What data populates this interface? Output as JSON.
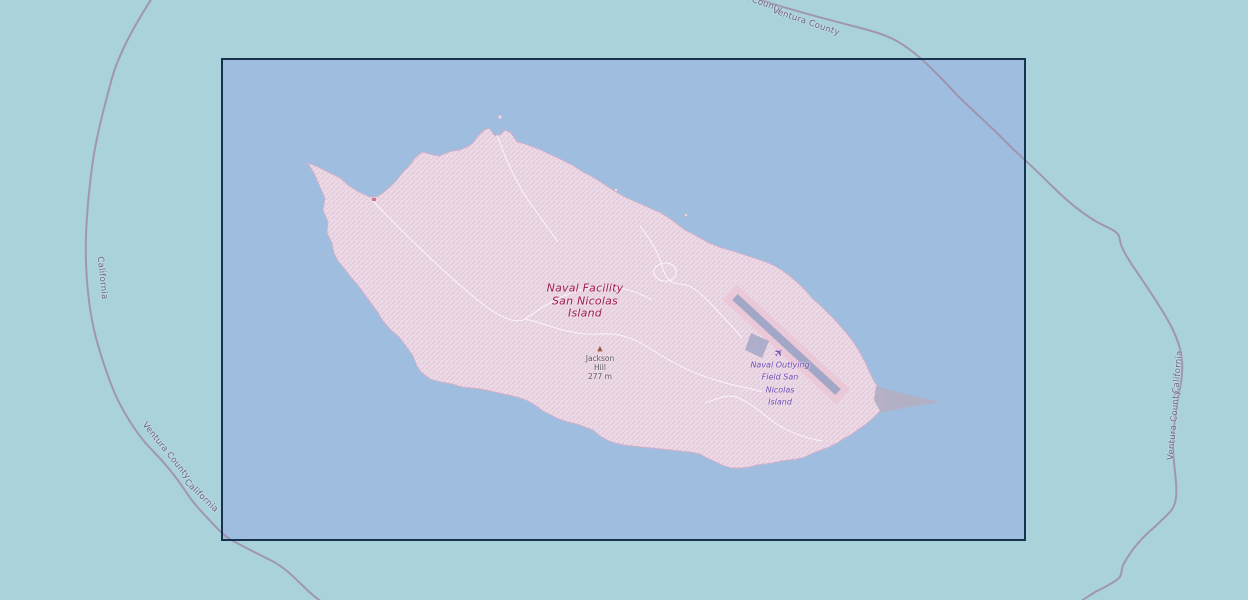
{
  "map": {
    "labels": {
      "naval_facility": {
        "lines": [
          "Naval Facility",
          "San Nicolas",
          "Island"
        ]
      },
      "peak": {
        "lines": [
          "Jackson",
          "Hill",
          "277 m"
        ]
      },
      "airfield": {
        "lines": [
          "Naval Outlying",
          "Field San",
          "Nicolas",
          "Island"
        ]
      },
      "boundaries": [
        {
          "text": "Santa Barbara County"
        },
        {
          "text": "Ventura County"
        },
        {
          "text": "California"
        },
        {
          "text": "Ventura County"
        },
        {
          "text": "California"
        },
        {
          "text": "California"
        },
        {
          "text": "Ventura County"
        }
      ]
    },
    "icons": {
      "airfield_glyph": "✈",
      "peak_glyph": "▲"
    },
    "colors": {
      "ocean_outside": "#aad2da",
      "ocean_inside": "#9fbedf",
      "viewport_border": "#16324f",
      "military_area_fill": "#ecdbe7",
      "military_hatch": "#e1c3d6",
      "military_label": "#9e1d4a",
      "boundary_line": "#9e90aa",
      "boundary_label": "#6d6186",
      "runway": "#a2a7c7",
      "aeroway_area": "#eac6d5",
      "sand_spit": "#b3afc3",
      "airfield_label": "#6a4fb4",
      "peak_label": "#5d5d5d",
      "peak_icon": "#9e5a3e",
      "track_line": "#ffffff"
    }
  }
}
